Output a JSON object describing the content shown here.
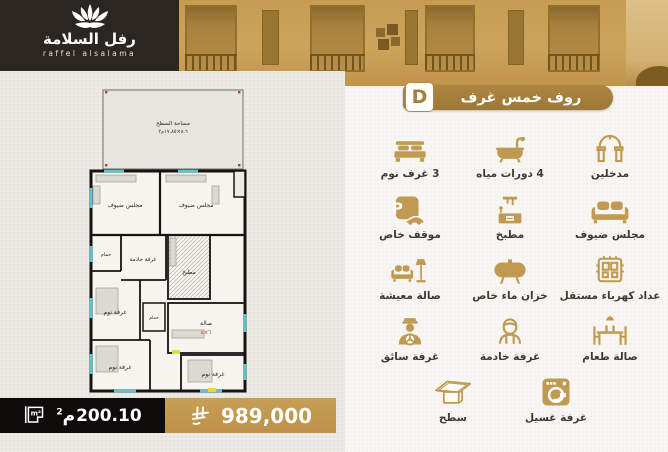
{
  "brand": {
    "name_ar": "رفل السلامة",
    "name_en": "raffel alsalama",
    "logo_icon": "lotus-icon"
  },
  "unit": {
    "badge_letter": "D",
    "title": "روف خمس غرف"
  },
  "features": [
    {
      "icon": "arch-icon",
      "label": "مدخلين"
    },
    {
      "icon": "bathtub-icon",
      "label": "4 دورات مياه"
    },
    {
      "icon": "bed-icon",
      "label": "3 غرف نوم"
    },
    {
      "icon": "sofa-icon",
      "label": "مجلس ضيوف"
    },
    {
      "icon": "kitchen-icon",
      "label": "مطبخ"
    },
    {
      "icon": "parking-icon",
      "label": "موقف خاص"
    },
    {
      "icon": "meter-icon",
      "label": "عداد كهرباء مستقل"
    },
    {
      "icon": "tank-icon",
      "label": "خزان ماء خاص"
    },
    {
      "icon": "living-icon",
      "label": "صالة معيشة"
    },
    {
      "icon": "dining-icon",
      "label": "صالة طعام"
    },
    {
      "icon": "maid-icon",
      "label": "غرفة خادمة"
    },
    {
      "icon": "driver-icon",
      "label": "غرفة سائق"
    }
  ],
  "features_last_row": [
    {
      "icon": "washer-icon",
      "label": "غرفة غسيل"
    },
    {
      "icon": "roof-icon",
      "label": "سطح"
    }
  ],
  "pricing": {
    "area_value": "200.10",
    "area_unit_letter": "م",
    "area_unit_sup": "2",
    "area_icon": "area-m2-icon",
    "price": "989,000",
    "currency_icon": "saudi-riyal-icon"
  },
  "floor_plan": {
    "roof_label": "مساحة السطح",
    "roof_dims": "٨.٦×١٧.٨٥م٢",
    "rooms": {
      "majlis_a": "مجلس ضيوف",
      "majlis_b": "مجلس ضيوف",
      "bath_a": "حمام",
      "maid": "غرفة خادمة",
      "kitchen": "مطبخ",
      "bed_a": "غرفة نوم",
      "hall": "صالة",
      "hall_dims": "٦×٤",
      "bath_b": "حمام",
      "bed_b": "غرفة نوم",
      "bed_c": "غرفة نوم"
    }
  },
  "colors": {
    "gold": "#bf9a50",
    "banner_gold": "#a5803e",
    "price_gold": "#c49a4d",
    "dark": "#0d0c0b",
    "label": "#3e3a33",
    "window_cyan": "#59c6d6"
  }
}
